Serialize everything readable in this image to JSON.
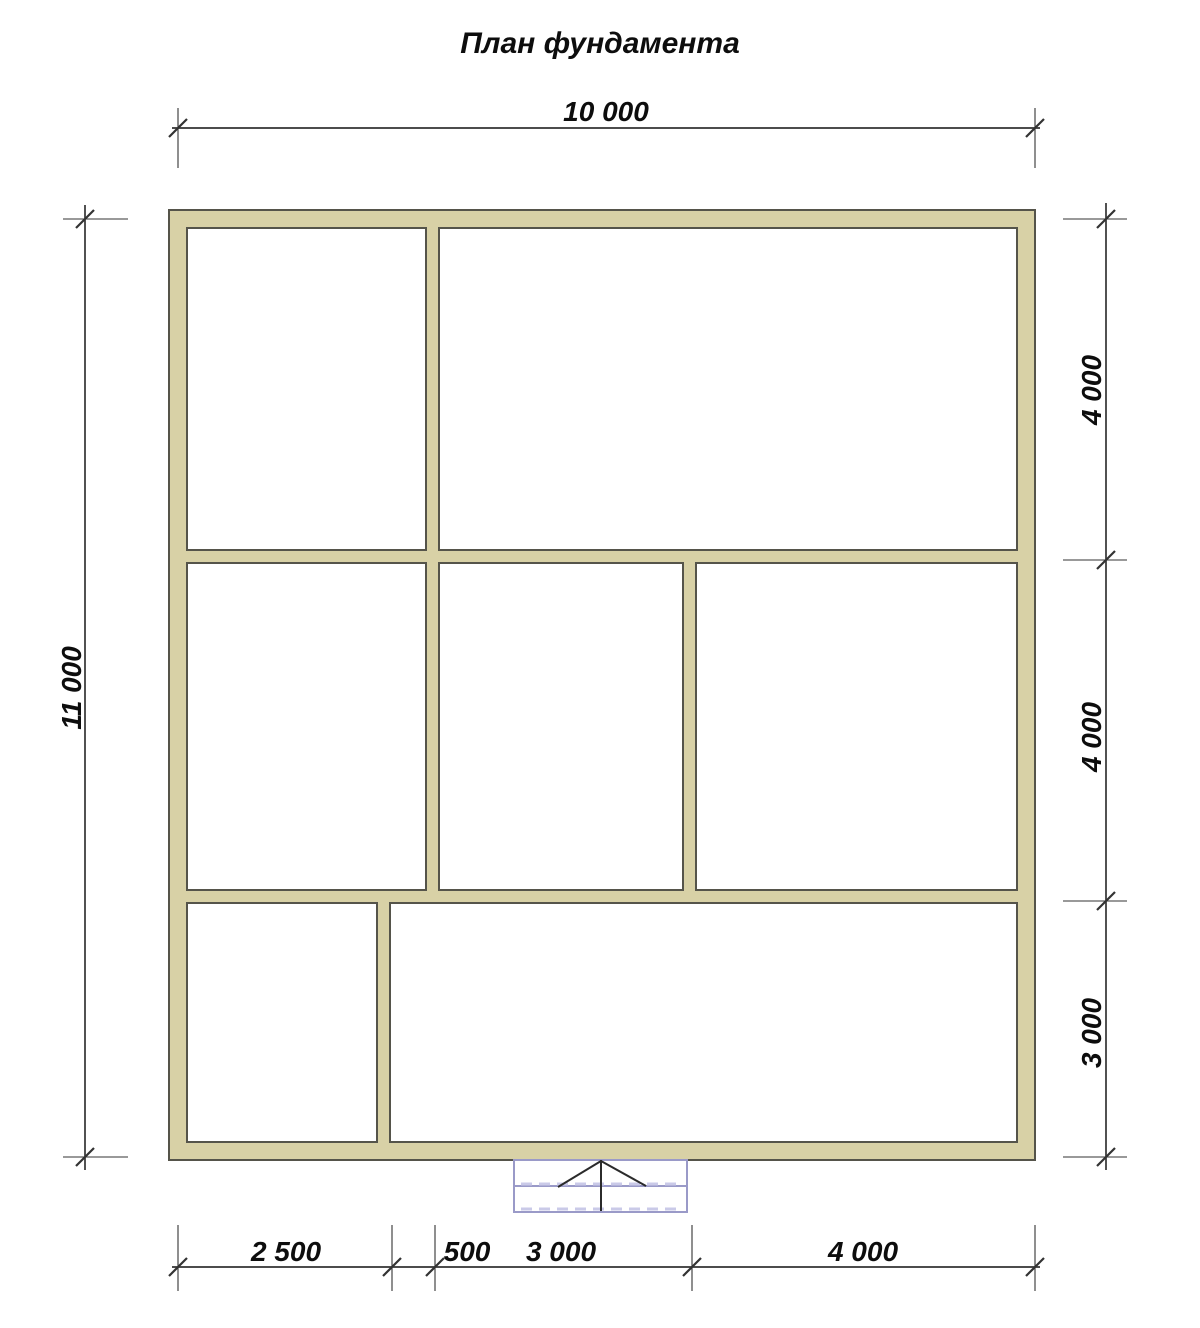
{
  "title": "План фундамента",
  "dimensions": {
    "top": {
      "label": "10 000"
    },
    "left": {
      "label": "11 000"
    },
    "right": [
      {
        "label": "4 000"
      },
      {
        "label": "4 000"
      },
      {
        "label": "3 000"
      }
    ],
    "bottom": [
      {
        "label": "2 500"
      },
      {
        "label": "500"
      },
      {
        "label": "3 000"
      },
      {
        "label": "4 000"
      }
    ]
  },
  "colors": {
    "wall-fill": "#d8d1a6",
    "wall-stroke": "#55544a",
    "ink": "#333333",
    "text": "#0d0d0d",
    "porch": "#9a9ac8",
    "porch-dash": "#cacae8",
    "bg": "#ffffff"
  }
}
